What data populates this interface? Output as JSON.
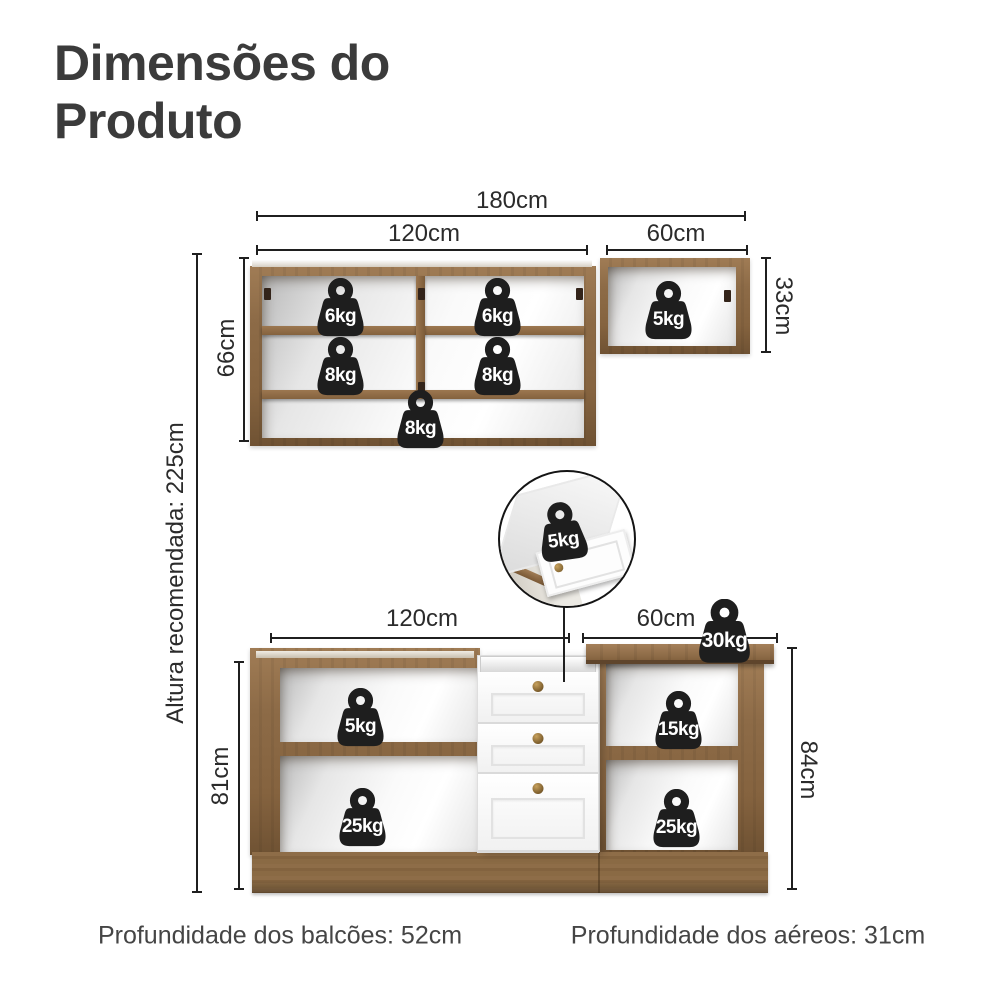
{
  "title": "Dimensões do Produto",
  "colors": {
    "wood": "#8d6b47",
    "wood_dark": "#6f5233",
    "badge": "#1e1e1e",
    "text": "#3b3b3b",
    "line": "#1f1f1f"
  },
  "upper_section": {
    "total_width": "180cm",
    "left_cabinet": {
      "width": "120cm",
      "height": "66cm",
      "weights": {
        "top_left": "6kg",
        "top_right": "6kg",
        "middle_left": "8kg",
        "middle_right": "8kg",
        "bottom": "8kg"
      }
    },
    "right_cabinet": {
      "width": "60cm",
      "height": "33cm",
      "weight": "5kg"
    }
  },
  "recommended_height": "Altura recomendada: 225cm",
  "drawer_detail": {
    "weight": "5kg"
  },
  "lower_section": {
    "left_cabinet": {
      "width": "120cm",
      "height": "81cm",
      "weights": {
        "top": "5kg",
        "bottom": "25kg"
      }
    },
    "right_cabinet": {
      "width": "60cm",
      "height": "84cm",
      "countertop_weight": "30kg",
      "weights": {
        "top": "15kg",
        "bottom": "25kg"
      }
    }
  },
  "footer": {
    "counters_depth": "Profundidade dos balcões: 52cm",
    "wall_cabinets_depth": "Profundidade dos aéreos: 31cm"
  }
}
